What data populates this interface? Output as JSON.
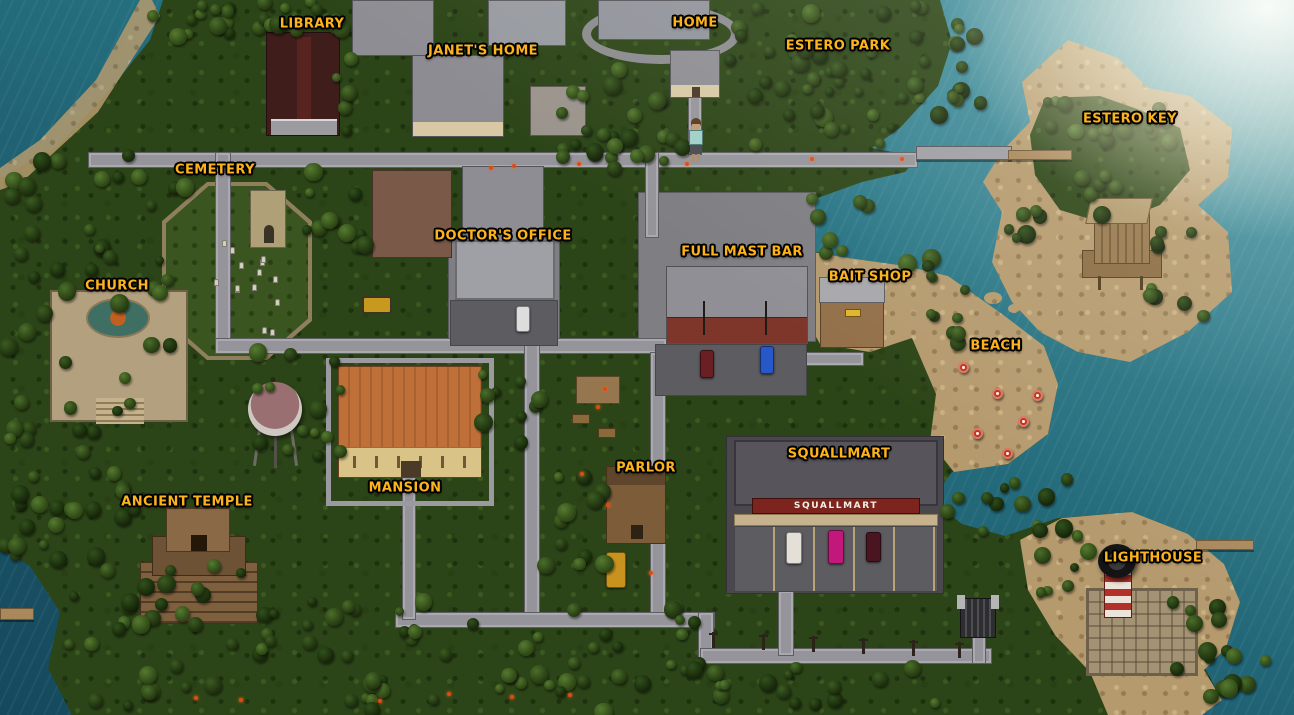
{
  "game_map": {
    "locations": [
      {
        "id": "library",
        "label": "LIBRARY",
        "x": 312,
        "y": 24
      },
      {
        "id": "janets-home",
        "label": "JANET'S HOME",
        "x": 483,
        "y": 51
      },
      {
        "id": "home",
        "label": "HOME",
        "x": 695,
        "y": 23
      },
      {
        "id": "estero-park",
        "label": "ESTERO PARK",
        "x": 838,
        "y": 46
      },
      {
        "id": "estero-key",
        "label": "ESTERO KEY",
        "x": 1130,
        "y": 119
      },
      {
        "id": "cemetery",
        "label": "CEMETERY",
        "x": 215,
        "y": 170
      },
      {
        "id": "doctors-office",
        "label": "DOCTOR'S OFFICE",
        "x": 503,
        "y": 236
      },
      {
        "id": "full-mast-bar",
        "label": "FULL MAST BAR",
        "x": 742,
        "y": 252
      },
      {
        "id": "bait-shop",
        "label": "BAIT SHOP",
        "x": 870,
        "y": 277
      },
      {
        "id": "church",
        "label": "CHURCH",
        "x": 117,
        "y": 286
      },
      {
        "id": "beach",
        "label": "BEACH",
        "x": 996,
        "y": 346
      },
      {
        "id": "ancient-temple",
        "label": "ANCIENT TEMPLE",
        "x": 187,
        "y": 502
      },
      {
        "id": "mansion",
        "label": "MANSION",
        "x": 405,
        "y": 488
      },
      {
        "id": "parlor",
        "label": "PARLOR",
        "x": 646,
        "y": 468
      },
      {
        "id": "squallmart",
        "label": "SQUALLMART",
        "x": 839,
        "y": 454
      },
      {
        "id": "lighthouse",
        "label": "LIGHTHOUSE",
        "x": 1153,
        "y": 558
      }
    ],
    "signs": {
      "squallmart_storefront": "SQUALLMART"
    },
    "player": {
      "x": 694,
      "y": 118
    },
    "colors": {
      "label_gold": "#fcb31c",
      "ocean_deep": "#154a5e",
      "ocean_light": "#5da6ae",
      "jungle_green": "#2c4518",
      "sand": "#b59a6e",
      "road_gray": "#94949a",
      "squallmart_sign_red": "#7e241e",
      "lighthouse_stripe_red": "#b23229"
    }
  }
}
